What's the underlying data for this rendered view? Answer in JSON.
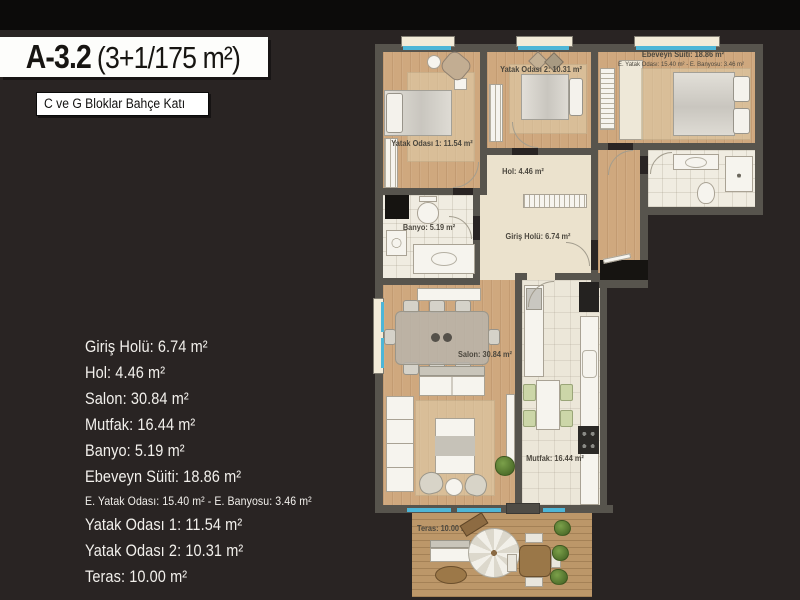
{
  "header": {
    "title_code": "A-3.2",
    "title_spec": "(3+1/175 m²)",
    "subtitle": "C ve G Bloklar Bahçe Katı"
  },
  "area_list": [
    {
      "text": "Giriş Holü: 6.74 m²"
    },
    {
      "text": "Hol: 4.46 m²"
    },
    {
      "text": "Salon: 30.84 m²"
    },
    {
      "text": "Mutfak: 16.44 m²"
    },
    {
      "text": "Banyo: 5.19 m²"
    },
    {
      "text": "Ebeveyn Süiti: 18.86 m²"
    },
    {
      "text": "E. Yatak Odası: 15.40 m² - E. Banyosu: 3.46 m²",
      "small": true
    },
    {
      "text": "Yatak Odası 1: 11.54 m²"
    },
    {
      "text": "Yatak Odası 2: 10.31 m²"
    },
    {
      "text": "Teras: 10.00 m²"
    }
  ],
  "plan_labels": {
    "yatak_odasi_1": "Yatak Odası 1: 11.54 m²",
    "yatak_odasi_2": "Yatak Odası 2: 10.31 m²",
    "ebeveyn": "Ebeveyn Süiti: 18.86 m²",
    "ebeveyn_sub": "E. Yatak Odası: 15.40 m² - E. Banyosu: 3.46 m²",
    "hol": "Hol: 4.46 m²",
    "banyo": "Banyo: 5.19 m²",
    "giris_holu": "Giriş Holü: 6.74 m²",
    "salon": "Salon: 30.84 m²",
    "mutfak": "Mutfak: 16.44 m²",
    "teras": "Teras: 10.00 m²"
  },
  "colors": {
    "background": "#292423",
    "top_bar": "#0c0b0a",
    "wall": "#57544d",
    "wood_floor": "#cfa87e",
    "hall_floor": "#ebe2cd",
    "tile_floor": "#f0ece1",
    "deck_floor": "#bc9769",
    "window_glass": "#4db6d7",
    "plan_label_text": "#4b473e",
    "list_text": "#f2f0ec"
  }
}
